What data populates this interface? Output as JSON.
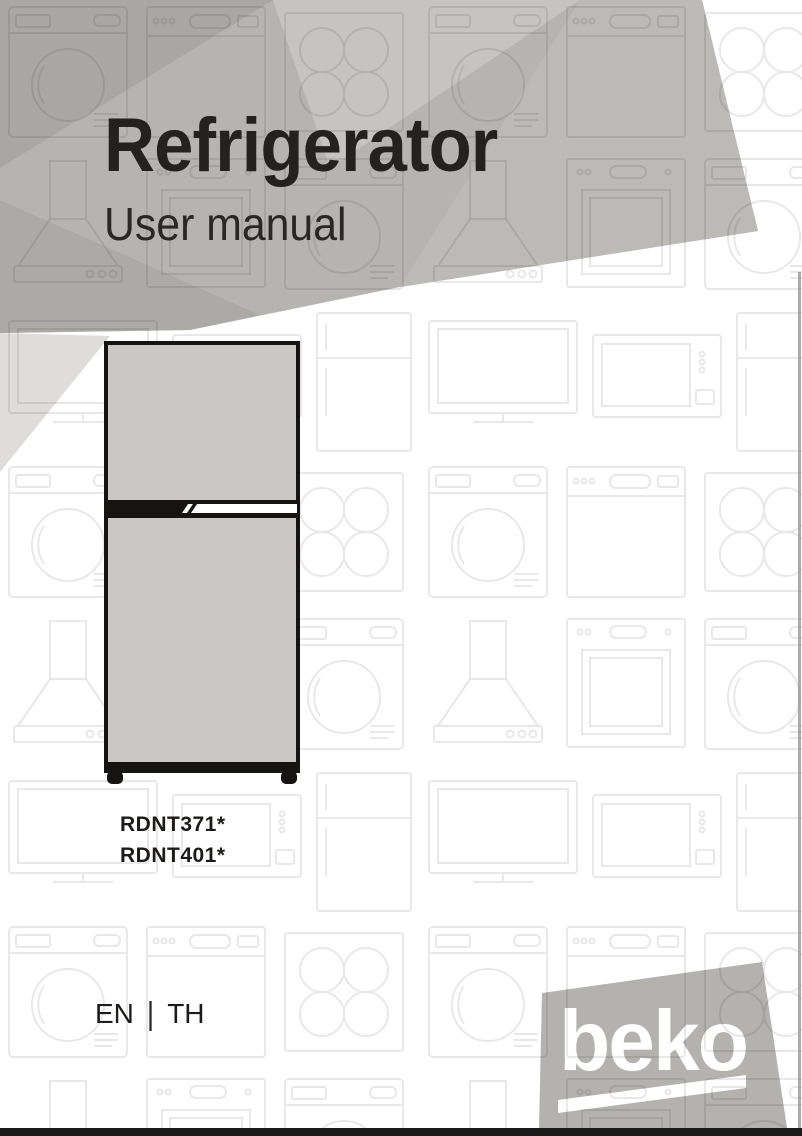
{
  "page": {
    "width": 802,
    "height": 1136,
    "background": "#ffffff"
  },
  "header": {
    "title": "Refrigerator",
    "subtitle": "User manual",
    "text_color": "#242220",
    "banner_colors": {
      "base": "#b6b4b1",
      "dark_wedge": "#a9a7a4",
      "light_wedge": "#c6c4c1",
      "right_facet": "#bcbab7",
      "bottom_wedge": "#abaaa7",
      "pale_under_wedge": "#dedddb"
    }
  },
  "models": {
    "lines": [
      "RDNT371*",
      "RDNT401*"
    ]
  },
  "languages": {
    "first": "EN",
    "separator": "|",
    "second": "TH"
  },
  "brand": {
    "wordmark": "beko",
    "box_color": "#b4b2af",
    "text_color": "#ffffff"
  },
  "illustration": {
    "type": "top-freezer refrigerator, front view",
    "door_color": "#c9c8c5",
    "outline_color": "#161412",
    "handle_color": "#ffffff"
  },
  "background_pattern": {
    "style": "light outlined home-appliance grid",
    "stroke": "#e8e8e8",
    "appliances": [
      "washing machine",
      "dishwasher",
      "cooktop",
      "range hood",
      "built-in oven",
      "tv",
      "microwave",
      "refrigerator"
    ]
  },
  "footer": {
    "bar_color": "#191919"
  }
}
